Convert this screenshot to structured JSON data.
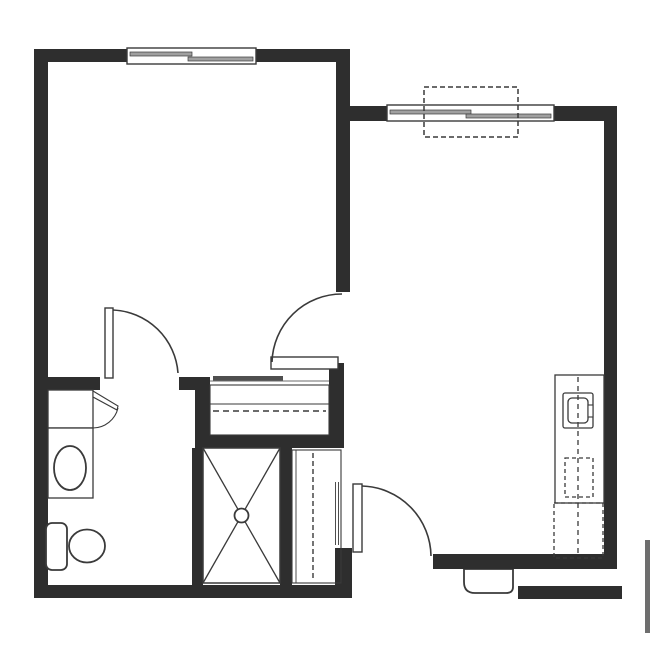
{
  "title": "one-bedroom-apartment-floor-plan",
  "colors": {
    "wall": "#2e2e2e",
    "line": "#3a3a3a",
    "white": "#ffffff",
    "pane": "#a0a0a0",
    "slider": "#4f4f4f",
    "gray_bar": "#6e6e6e",
    "bg": "#ffffff"
  },
  "canvas": {
    "width": 650,
    "height": 650
  },
  "rooms": [
    {
      "name": "bedroom",
      "area": "top-left"
    },
    {
      "name": "living-room-kitchen",
      "area": "right"
    },
    {
      "name": "bathroom",
      "area": "bottom-left"
    },
    {
      "name": "closet",
      "area": "center"
    },
    {
      "name": "shower",
      "area": "bottom-center"
    },
    {
      "name": "entry",
      "area": "bottom-right"
    }
  ],
  "shapes": [
    {
      "name": "entry-threshold",
      "type": "path",
      "d": "M 464 569 L 513 569 L 513 587 Q 513 593 506 593 L 475 593 Q 464 593 464 582 Z",
      "fill": "white",
      "stroke": "line",
      "sw": 1.8
    },
    {
      "name": "wall-bedroom-top-left",
      "type": "rect",
      "x": 34,
      "y": 49,
      "w": 93,
      "h": 13,
      "fill": "wall"
    },
    {
      "name": "wall-bedroom-top-right",
      "type": "rect",
      "x": 256,
      "y": 49,
      "w": 94,
      "h": 13,
      "fill": "wall"
    },
    {
      "name": "wall-left",
      "type": "rect",
      "x": 34,
      "y": 49,
      "w": 14,
      "h": 549,
      "fill": "wall"
    },
    {
      "name": "wall-bottom-left",
      "type": "rect",
      "x": 34,
      "y": 585,
      "w": 313,
      "h": 13,
      "fill": "wall"
    },
    {
      "name": "wall-bedroom-right",
      "type": "rect",
      "x": 336,
      "y": 49,
      "w": 14,
      "h": 243,
      "fill": "wall"
    },
    {
      "name": "wall-living-top-left",
      "type": "rect",
      "x": 336,
      "y": 106,
      "w": 51,
      "h": 15,
      "fill": "wall"
    },
    {
      "name": "wall-living-top-right",
      "type": "rect",
      "x": 554,
      "y": 106,
      "w": 63,
      "h": 15,
      "fill": "wall"
    },
    {
      "name": "wall-living-right",
      "type": "rect",
      "x": 604,
      "y": 106,
      "w": 13,
      "h": 463,
      "fill": "wall"
    },
    {
      "name": "wall-living-bottom",
      "type": "rect",
      "x": 433,
      "y": 554,
      "w": 184,
      "h": 15,
      "fill": "wall"
    },
    {
      "name": "wall-corridor",
      "type": "rect",
      "x": 518,
      "y": 586,
      "w": 104,
      "h": 13,
      "fill": "wall"
    },
    {
      "name": "wall-entry-stub",
      "type": "rect",
      "x": 335,
      "y": 548,
      "w": 17,
      "h": 50,
      "fill": "wall"
    },
    {
      "name": "wall-bath-left-segment",
      "type": "rect",
      "x": 48,
      "y": 377,
      "w": 52,
      "h": 13,
      "fill": "wall"
    },
    {
      "name": "wall-bath-right-segment",
      "type": "rect",
      "x": 179,
      "y": 377,
      "w": 31,
      "h": 13,
      "fill": "wall"
    },
    {
      "name": "wall-closet-left",
      "type": "rect",
      "x": 195,
      "y": 377,
      "w": 15,
      "h": 71,
      "fill": "wall"
    },
    {
      "name": "wall-closet-bottom",
      "type": "rect",
      "x": 195,
      "y": 435,
      "w": 149,
      "h": 13,
      "fill": "wall"
    },
    {
      "name": "wall-closet-right",
      "type": "rect",
      "x": 329,
      "y": 363,
      "w": 15,
      "h": 85,
      "fill": "wall"
    },
    {
      "name": "wall-shower-left",
      "type": "rect",
      "x": 192,
      "y": 448,
      "w": 11,
      "h": 137,
      "fill": "wall"
    },
    {
      "name": "wall-shower-right",
      "type": "rect",
      "x": 280,
      "y": 448,
      "w": 12,
      "h": 137,
      "fill": "wall"
    },
    {
      "name": "corridor-edge-bar",
      "type": "rect",
      "x": 645,
      "y": 540,
      "w": 5,
      "h": 93,
      "fill": "gray_bar"
    },
    {
      "name": "bedroom-window-frame",
      "type": "rect",
      "x": 127,
      "y": 48,
      "w": 129,
      "h": 16,
      "fill": "white",
      "stroke": "line",
      "sw": 1.4
    },
    {
      "name": "bedroom-window-pane-left",
      "type": "rect",
      "x": 130,
      "y": 52,
      "w": 62,
      "h": 4,
      "fill": "pane",
      "stroke": "line",
      "sw": 0.7
    },
    {
      "name": "bedroom-window-pane-right",
      "type": "rect",
      "x": 188,
      "y": 57,
      "w": 65,
      "h": 4,
      "fill": "pane",
      "stroke": "line",
      "sw": 0.7
    },
    {
      "name": "living-window-frame",
      "type": "rect",
      "x": 387,
      "y": 105,
      "w": 167,
      "h": 16,
      "fill": "white",
      "stroke": "line",
      "sw": 1.4
    },
    {
      "name": "living-window-pane-left",
      "type": "rect",
      "x": 390,
      "y": 110,
      "w": 81,
      "h": 4,
      "fill": "pane",
      "stroke": "line",
      "sw": 0.7
    },
    {
      "name": "living-window-pane-right",
      "type": "rect",
      "x": 466,
      "y": 114,
      "w": 85,
      "h": 4,
      "fill": "pane",
      "stroke": "line",
      "sw": 0.7
    },
    {
      "name": "window-marker-dashed-box",
      "type": "rect",
      "x": 424,
      "y": 87,
      "w": 94,
      "h": 50,
      "fill": "none",
      "stroke": "line",
      "sw": 1.5,
      "dash": "5 3"
    },
    {
      "name": "closet-interior",
      "type": "rect",
      "x": 210,
      "y": 385,
      "w": 119,
      "h": 50,
      "fill": "none",
      "stroke": "line",
      "sw": 1.1
    },
    {
      "name": "closet-shelf-line",
      "type": "line",
      "x1": 210,
      "y1": 404,
      "x2": 329,
      "y2": 404,
      "stroke": "line",
      "sw": 1
    },
    {
      "name": "closet-rod-dashed-line",
      "type": "line",
      "x1": 213,
      "y1": 411,
      "x2": 326,
      "y2": 411,
      "stroke": "line",
      "sw": 1.4,
      "dash": "6 4"
    },
    {
      "name": "closet-front-track-line",
      "type": "line",
      "x1": 210,
      "y1": 381,
      "x2": 329,
      "y2": 381,
      "stroke": "line",
      "sw": 0.8
    },
    {
      "name": "closet-slider-panel",
      "type": "rect",
      "x": 213,
      "y": 376,
      "w": 70,
      "h": 4.5,
      "fill": "slider"
    },
    {
      "name": "bedroom-door-leaf",
      "type": "rect",
      "x": 271,
      "y": 357,
      "w": 67,
      "h": 12,
      "fill": "white",
      "stroke": "line",
      "sw": 1.4
    },
    {
      "name": "bedroom-door-swing-arc",
      "type": "path",
      "d": "M 272 362 A 70 70 0 0 1 342 294",
      "fill": "none",
      "stroke": "line",
      "sw": 1.6
    },
    {
      "name": "bathroom-door-leaf",
      "type": "rect",
      "x": 105,
      "y": 308,
      "w": 8,
      "h": 70,
      "fill": "white",
      "stroke": "line",
      "sw": 1.4
    },
    {
      "name": "bathroom-door-swing-arc",
      "type": "path",
      "d": "M 113 310 A 68 68 0 0 1 178 373",
      "fill": "none",
      "stroke": "line",
      "sw": 1.6
    },
    {
      "name": "linen-cabinet",
      "type": "rect",
      "x": 48,
      "y": 390,
      "w": 45,
      "h": 38,
      "fill": "white",
      "stroke": "line",
      "sw": 1.3
    },
    {
      "name": "cabinet-door-wedge",
      "type": "path",
      "d": "M 93 391 L 118 406 L 117 410 L 93 397 Z",
      "fill": "white",
      "stroke": "line",
      "sw": 1.1
    },
    {
      "name": "cabinet-door-swing-arc",
      "type": "path",
      "d": "M 118 408 A 26 26 0 0 1 93 428",
      "fill": "none",
      "stroke": "line",
      "sw": 1.1
    },
    {
      "name": "vanity-counter",
      "type": "rect",
      "x": 48,
      "y": 428,
      "w": 45,
      "h": 70,
      "fill": "white",
      "stroke": "line",
      "sw": 1.3
    },
    {
      "name": "vanity-sink",
      "type": "ellipse",
      "cx": 70,
      "cy": 468,
      "rx": 16,
      "ry": 22,
      "fill": "white",
      "stroke": "line",
      "sw": 1.8
    },
    {
      "name": "toilet-tank",
      "type": "rect",
      "x": 46,
      "y": 523,
      "w": 21,
      "h": 47,
      "r": 6,
      "fill": "white",
      "stroke": "line",
      "sw": 1.8
    },
    {
      "name": "toilet-bowl",
      "type": "ellipse",
      "cx": 87,
      "cy": 546,
      "rx": 18,
      "ry": 16.5,
      "fill": "white",
      "stroke": "line",
      "sw": 1.8
    },
    {
      "name": "shower-stall",
      "type": "rect",
      "x": 203,
      "y": 448,
      "w": 77,
      "h": 135,
      "fill": "none",
      "stroke": "line",
      "sw": 1.5
    },
    {
      "name": "shower-x-line-1",
      "type": "line",
      "x1": 203,
      "y1": 448,
      "x2": 280,
      "y2": 583,
      "stroke": "line",
      "sw": 1.3
    },
    {
      "name": "shower-x-line-2",
      "type": "line",
      "x1": 280,
      "y1": 448,
      "x2": 203,
      "y2": 583,
      "stroke": "line",
      "sw": 1.3
    },
    {
      "name": "shower-drain",
      "type": "circle",
      "cx": 241.5,
      "cy": 515.5,
      "rcirc": 7,
      "fill": "white",
      "stroke": "line",
      "sw": 1.8
    },
    {
      "name": "utility-chase-outline",
      "type": "rect",
      "x": 292,
      "y": 450,
      "w": 49,
      "h": 133,
      "fill": "none",
      "stroke": "line",
      "sw": 1.1
    },
    {
      "name": "utility-chase-inner-line",
      "type": "line",
      "x1": 296,
      "y1": 450,
      "x2": 296,
      "y2": 583,
      "stroke": "line",
      "sw": 0.9
    },
    {
      "name": "utility-chase-dashed-line",
      "type": "line",
      "x1": 313,
      "y1": 453,
      "x2": 313,
      "y2": 578,
      "stroke": "line",
      "sw": 1.4,
      "dash": "5 3"
    },
    {
      "name": "utility-chase-jamb-line-a",
      "type": "line",
      "x1": 335.5,
      "y1": 482,
      "x2": 335.5,
      "y2": 545,
      "stroke": "line",
      "sw": 0.9
    },
    {
      "name": "utility-chase-jamb-line-b",
      "type": "line",
      "x1": 338.5,
      "y1": 482,
      "x2": 338.5,
      "y2": 545,
      "stroke": "line",
      "sw": 0.9
    },
    {
      "name": "entry-door-leaf",
      "type": "rect",
      "x": 353,
      "y": 484,
      "w": 9,
      "h": 68,
      "fill": "white",
      "stroke": "line",
      "sw": 1.4
    },
    {
      "name": "entry-door-swing-arc",
      "type": "path",
      "d": "M 362 486 A 71 71 0 0 1 431 556",
      "fill": "none",
      "stroke": "line",
      "sw": 1.6
    },
    {
      "name": "kitchen-counter",
      "type": "rect",
      "x": 555,
      "y": 375,
      "w": 49,
      "h": 128,
      "fill": "white",
      "stroke": "line",
      "sw": 1.3
    },
    {
      "name": "kitchen-sink-outer",
      "type": "rect",
      "x": 563,
      "y": 393,
      "w": 30,
      "h": 35,
      "r": 2,
      "fill": "white",
      "stroke": "line",
      "sw": 1.3
    },
    {
      "name": "kitchen-sink-inner",
      "type": "rect",
      "x": 568,
      "y": 398,
      "w": 20,
      "h": 25,
      "r": 4,
      "fill": "none",
      "stroke": "line",
      "sw": 1.3
    },
    {
      "name": "kitchen-faucet",
      "type": "rect",
      "x": 588,
      "y": 405,
      "w": 5,
      "h": 12,
      "fill": "white",
      "stroke": "line",
      "sw": 1.1
    },
    {
      "name": "dishwasher-dashed-box",
      "type": "rect",
      "x": 565,
      "y": 458,
      "w": 28,
      "h": 39,
      "fill": "none",
      "stroke": "line",
      "sw": 1.3,
      "dash": "4 3"
    },
    {
      "name": "refrigerator-dashed-box",
      "type": "rect",
      "x": 554,
      "y": 503,
      "w": 49,
      "h": 55,
      "fill": "none",
      "stroke": "line",
      "sw": 1.3,
      "dash": "4 3"
    },
    {
      "name": "kitchen-counter-dashed-centerline",
      "type": "line",
      "x1": 578,
      "y1": 377,
      "x2": 578,
      "y2": 556,
      "stroke": "line",
      "sw": 1.3,
      "dash": "5 4"
    }
  ]
}
